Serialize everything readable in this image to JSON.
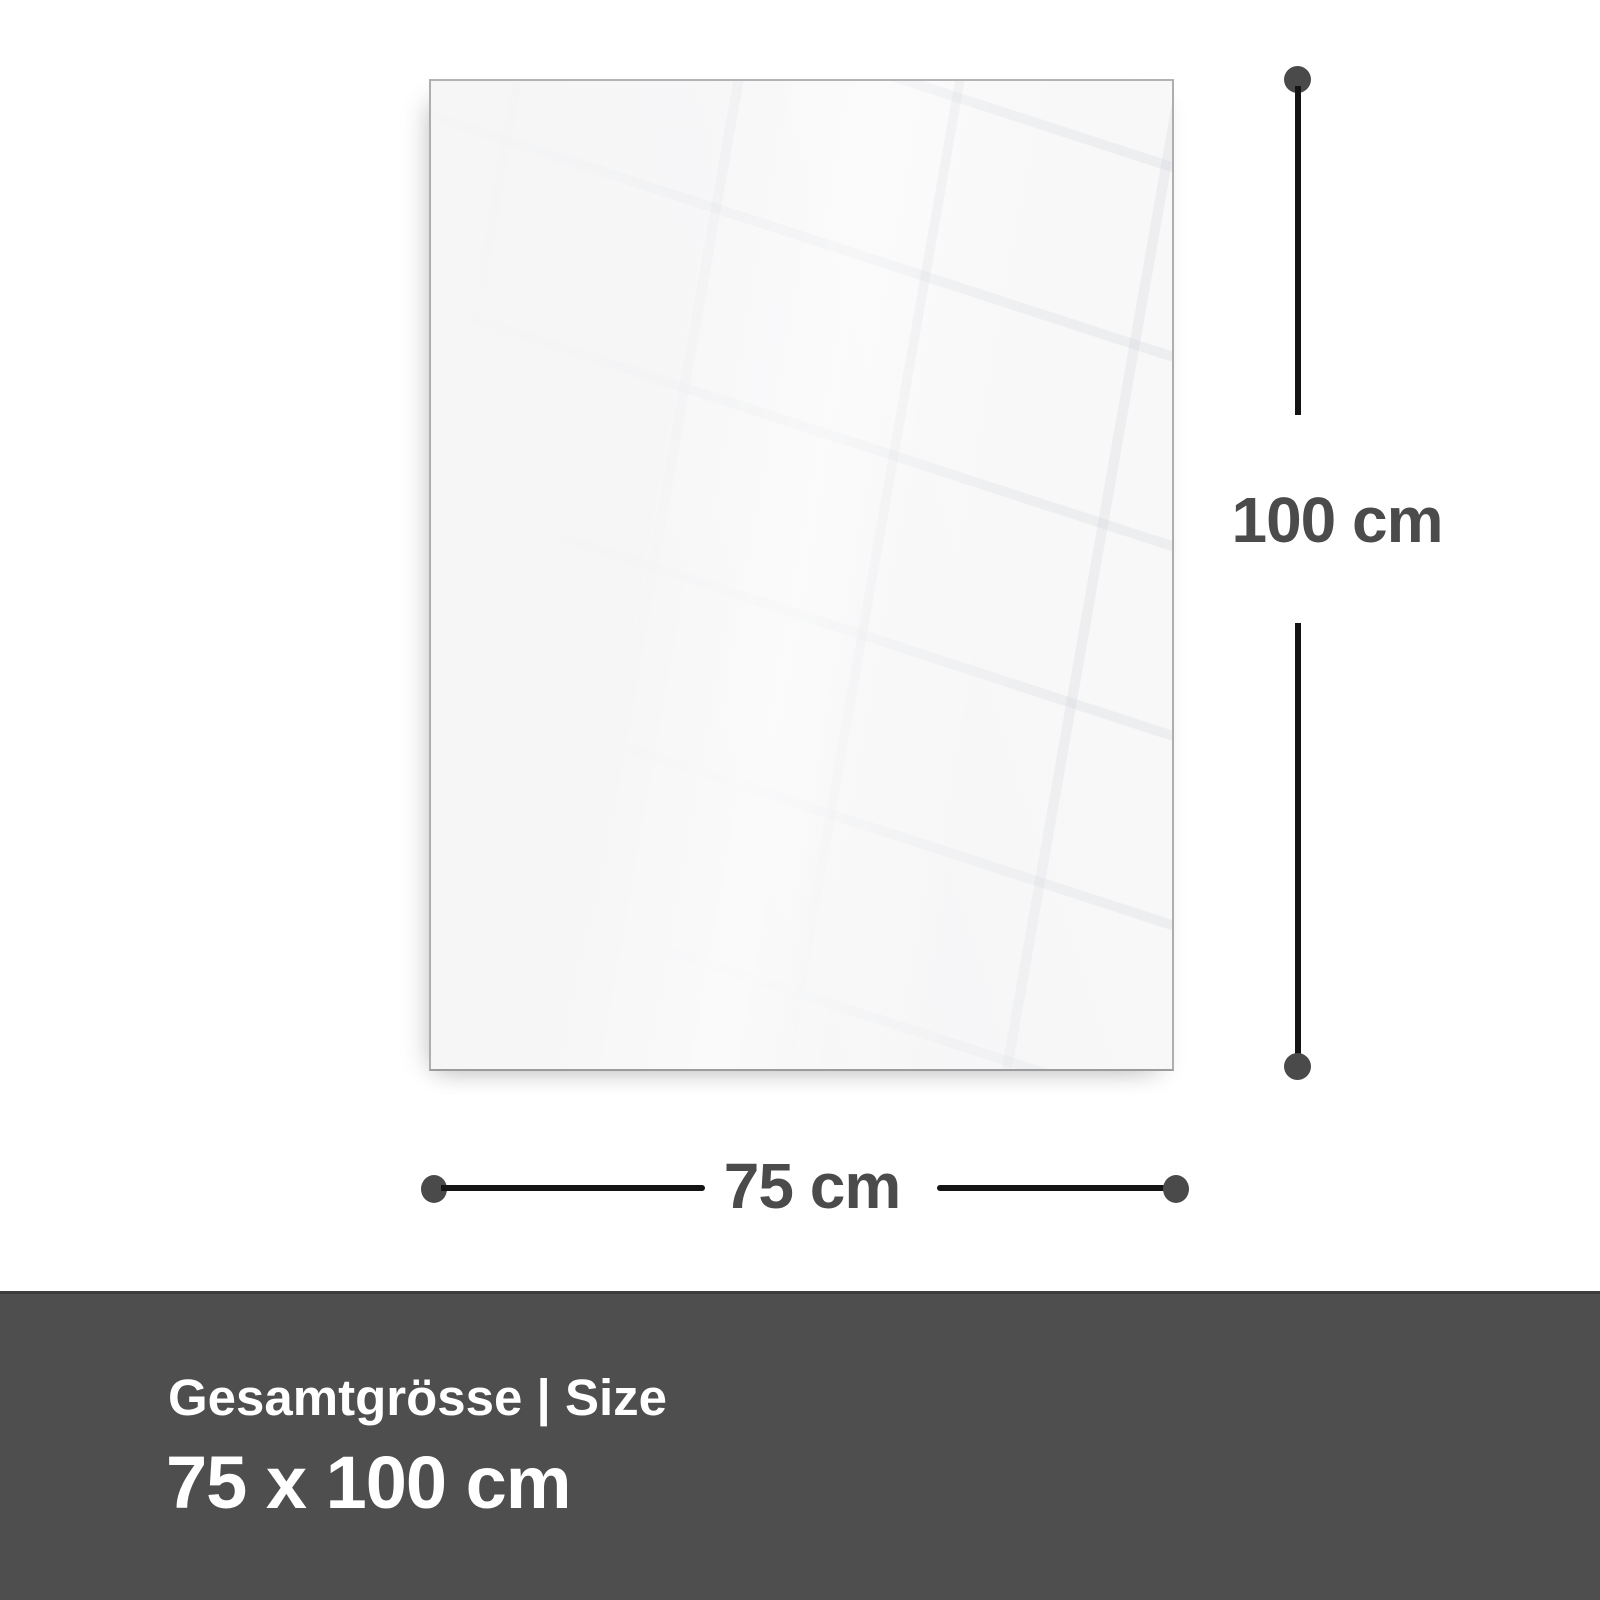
{
  "diagram": {
    "dimensions": {
      "height": {
        "label": "100 cm"
      },
      "width": {
        "label": "75 cm"
      }
    }
  },
  "footer": {
    "heading": "Gesamtgrösse | Size",
    "size": "75 x 100 cm"
  },
  "colors": {
    "page_bg": "#ffffff",
    "panel_fill": "#f6f6f7",
    "panel_border": "#aeaeb1",
    "dimension_line": "#141414",
    "dimension_dot": "#4a4a4a",
    "dimension_text": "#4b4b4b",
    "footer_bg": "#4e4e4e",
    "footer_top_border": "#3c3c3c",
    "footer_text": "#ffffff"
  }
}
